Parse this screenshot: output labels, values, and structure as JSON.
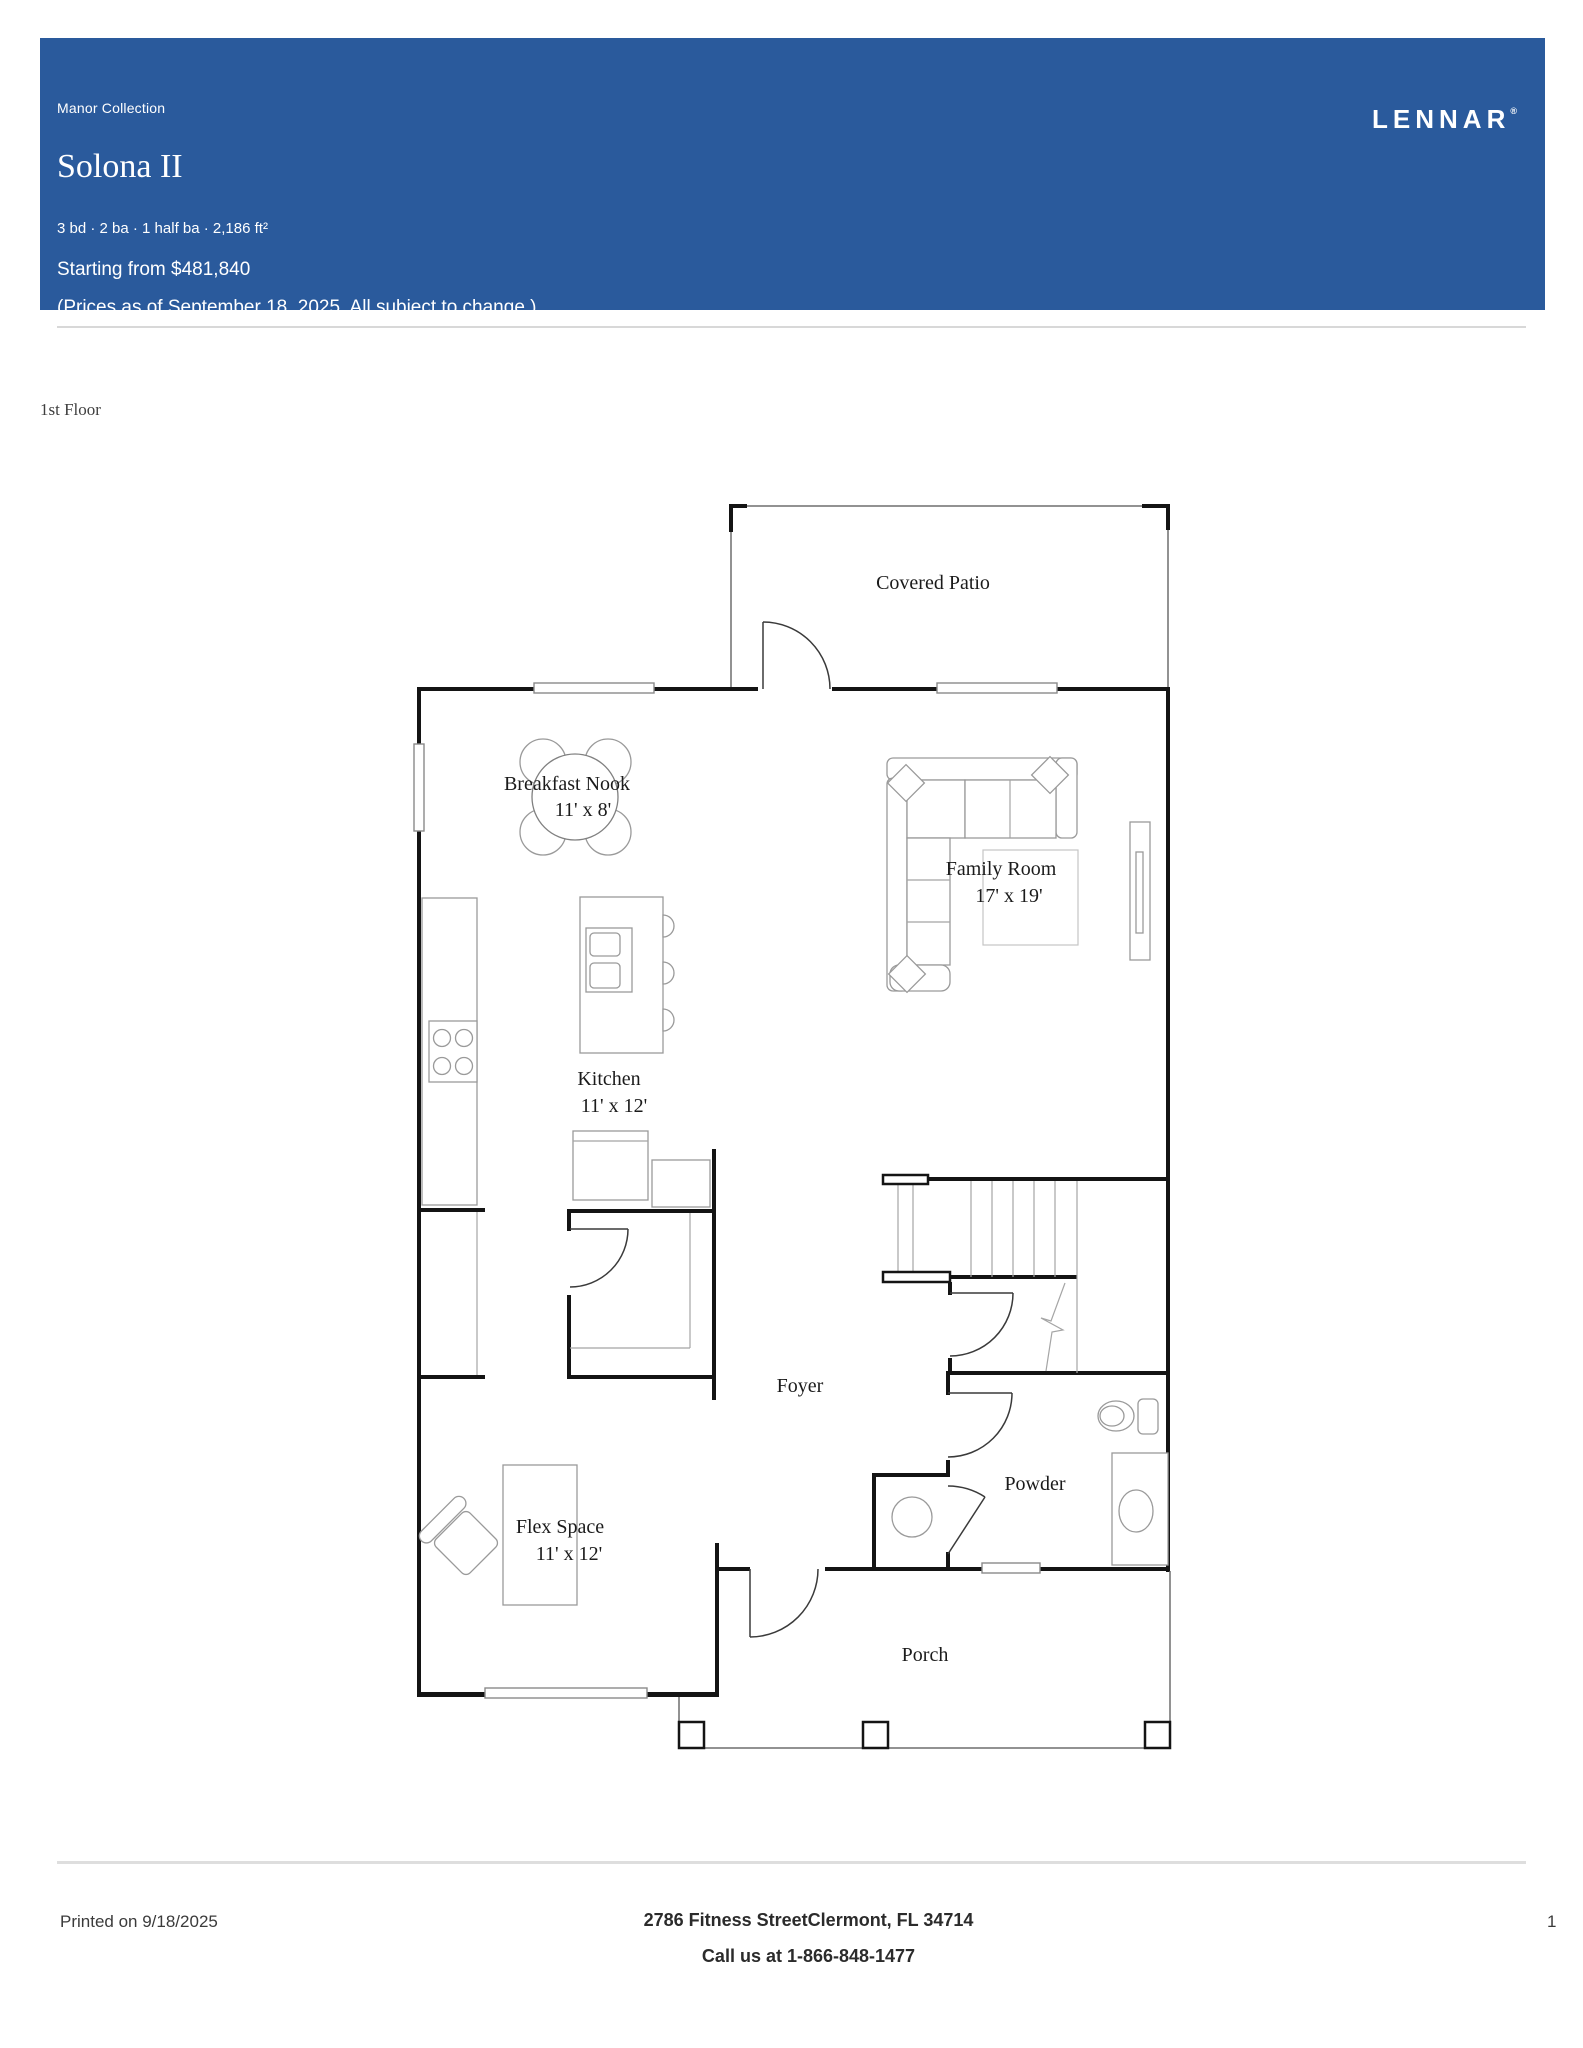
{
  "header": {
    "collection": "Manor Collection",
    "title": "Solona II",
    "specs": "3 bd · 2 ba · 1 half ba · 2,186 ft²",
    "price": "Starting from $481,840",
    "price_note": "(Prices as of September 18, 2025. All subject to change.)",
    "brand": {
      "logo": "LENNAR",
      "registered_mark": "®"
    },
    "banner_color": "#2a5a9c"
  },
  "floor": {
    "label": "1st Floor"
  },
  "plan": {
    "rooms": [
      {
        "id": "covered-patio",
        "name": "Covered Patio",
        "dims": ""
      },
      {
        "id": "breakfast-nook",
        "name": "Breakfast Nook",
        "dims": "11' x 8'"
      },
      {
        "id": "family-room",
        "name": "Family Room",
        "dims": "17' x 19'"
      },
      {
        "id": "kitchen",
        "name": "Kitchen",
        "dims": "11' x 12'"
      },
      {
        "id": "foyer",
        "name": "Foyer",
        "dims": ""
      },
      {
        "id": "powder",
        "name": "Powder",
        "dims": ""
      },
      {
        "id": "flex-space",
        "name": "Flex Space",
        "dims": "11' x 12'"
      },
      {
        "id": "porch",
        "name": "Porch",
        "dims": ""
      }
    ]
  },
  "footer": {
    "printed": "Printed on 9/18/2025",
    "address": "2786 Fitness StreetClermont, FL 34714",
    "phone": "Call us at 1-866-848-1477",
    "page": "1"
  }
}
